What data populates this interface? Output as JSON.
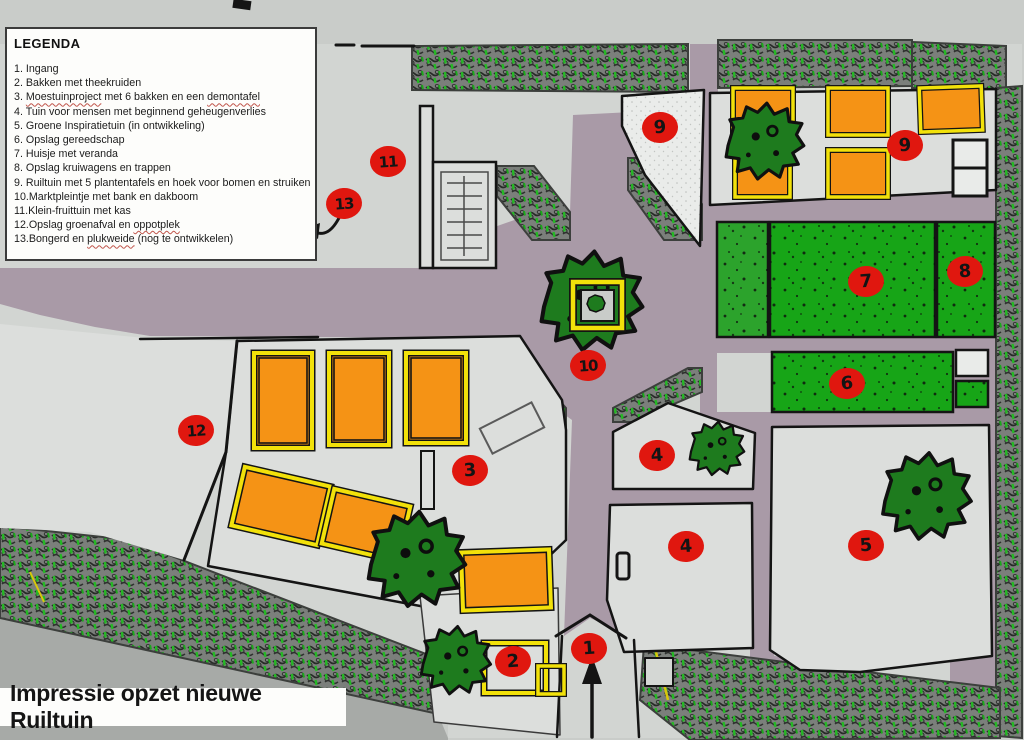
{
  "title_banner": "Impressie opzet nieuwe Ruiltuin",
  "legend": {
    "title": "LEGENDA",
    "items": [
      [
        {
          "t": "1. Ingang"
        }
      ],
      [
        {
          "t": "2. Bakken met theekruiden"
        }
      ],
      [
        {
          "t": "3. "
        },
        {
          "t": "Moestuinproject",
          "w": true
        },
        {
          "t": " met 6 bakken en een "
        },
        {
          "t": "demontafel",
          "w": true
        }
      ],
      [
        {
          "t": "4. Tuin voor mensen met beginnend geheugenverlies"
        }
      ],
      [
        {
          "t": "5. Groene Inspiratietuin (in ontwikkeling)"
        }
      ],
      [
        {
          "t": "6. Opslag gereedschap"
        }
      ],
      [
        {
          "t": "7. Huisje met veranda"
        }
      ],
      [
        {
          "t": "8. Opslag kruiwagens en trappen"
        }
      ],
      [
        {
          "t": "9. Ruiltuin met 5 plantentafels en hoek voor bomen en struiken"
        }
      ],
      [
        {
          "t": "10.Marktpleintje met bank en dakboom"
        }
      ],
      [
        {
          "t": "11.Klein-fruittuin met kas"
        }
      ],
      [
        {
          "t": "12.Opslag groenafval en "
        },
        {
          "t": "oppotplek",
          "w": true
        }
      ],
      [
        {
          "t": "13.Bongerd en "
        },
        {
          "t": "plukweide",
          "w": true
        },
        {
          "t": " (nog te ontwikkelen)"
        }
      ]
    ]
  },
  "markers": [
    {
      "label": "1",
      "x": 589,
      "y": 649
    },
    {
      "label": "2",
      "x": 513,
      "y": 662
    },
    {
      "label": "3",
      "x": 470,
      "y": 471
    },
    {
      "label": "4",
      "x": 657,
      "y": 456
    },
    {
      "label": "4",
      "x": 686,
      "y": 547
    },
    {
      "label": "5",
      "x": 866,
      "y": 546
    },
    {
      "label": "6",
      "x": 847,
      "y": 384
    },
    {
      "label": "7",
      "x": 866,
      "y": 282
    },
    {
      "label": "8",
      "x": 965,
      "y": 272
    },
    {
      "label": "9",
      "x": 660,
      "y": 128
    },
    {
      "label": "9",
      "x": 905,
      "y": 146
    },
    {
      "label": "10",
      "x": 588,
      "y": 366
    },
    {
      "label": "11",
      "x": 388,
      "y": 162
    },
    {
      "label": "12",
      "x": 196,
      "y": 431
    },
    {
      "label": "13",
      "x": 344,
      "y": 204
    }
  ],
  "colors": {
    "path_purple": "#a99aa7",
    "field_gray": "#dcdedc",
    "hedge_base": "#7b7f7b",
    "hedge_green": "#25b825",
    "block_green": "#17a517",
    "tree_green": "#1e7b1e",
    "bed_orange": "#f59315",
    "frame_yellow": "#f2e10a",
    "marker_red": "#e0170f",
    "outside_gray": "#a7aaa7"
  }
}
